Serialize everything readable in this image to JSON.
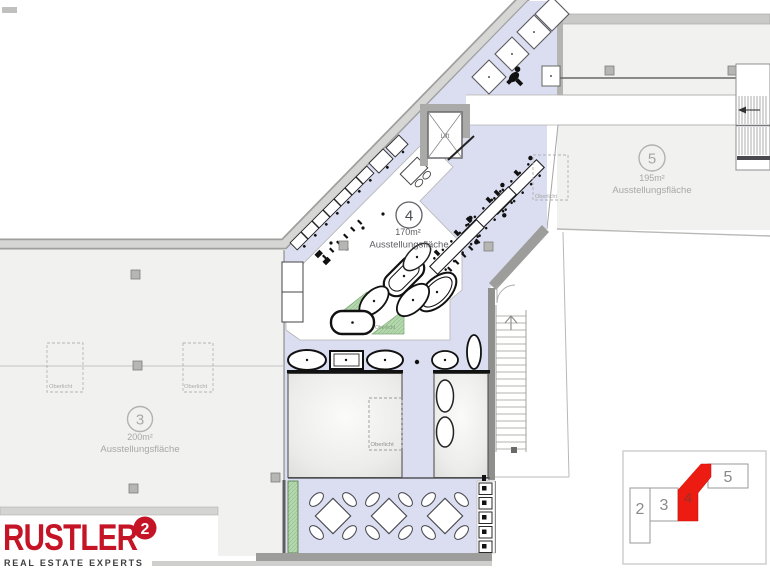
{
  "plan": {
    "areas": [
      {
        "number": "3",
        "area": "200m²",
        "label": "Ausstellungsfläche"
      },
      {
        "number": "4",
        "area": "170m²",
        "label": "Ausstellungsfläche"
      },
      {
        "number": "5",
        "area": "195m²",
        "label": "Ausstellungsfläche"
      }
    ],
    "annotations": {
      "lift": "Lift",
      "skylight": "Oberlicht"
    },
    "colors": {
      "unit_highlight_fill": "#dbdef1",
      "area_fill": "#f1f1ef",
      "wall_gray": "#cfcfcd",
      "plant_green": "#b5d7ae",
      "minimap_highlight": "#ed1c13"
    }
  },
  "minimap": {
    "units": [
      {
        "label": "2",
        "highlighted": false
      },
      {
        "label": "3",
        "highlighted": false
      },
      {
        "label": "4",
        "highlighted": true
      },
      {
        "label": "5",
        "highlighted": false
      }
    ]
  },
  "logo": {
    "brand": "RUSTLER",
    "mark": "2",
    "tagline": "REAL ESTATE EXPERTS",
    "brand_color": "#c41425",
    "tagline_color": "#3f3f41"
  }
}
